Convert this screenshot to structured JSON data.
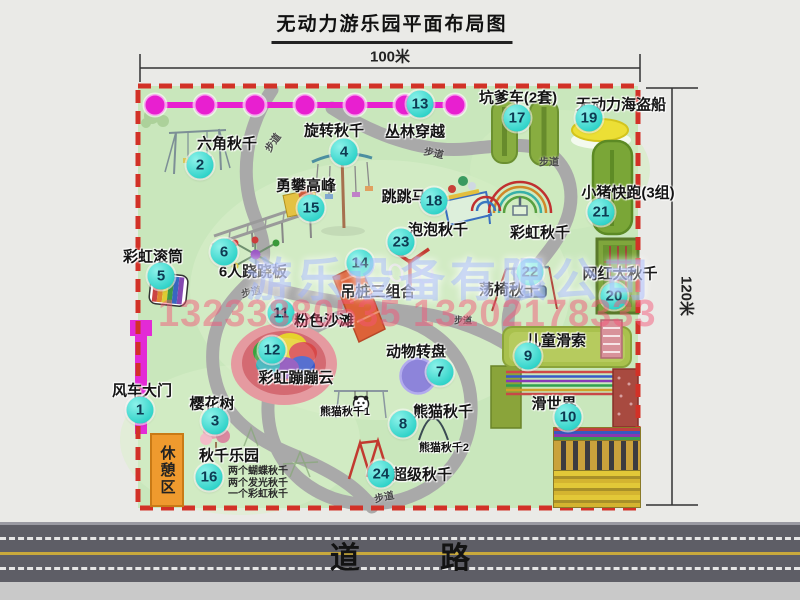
{
  "title": "无动力游乐园平面布局图",
  "dimensions": {
    "width": "100米",
    "height": "120米"
  },
  "road_label": "道 路",
  "rest_area_label": "休憩区",
  "path_label": "步道",
  "watermark": {
    "company": "游乐设备有限公司",
    "phone": "13233880535 13202178333"
  },
  "extra_labels": {
    "rainbow_swing": "彩虹秋千",
    "panda_swing_1": "熊猫秋千1",
    "panda_swing_2": "熊猫秋千2"
  },
  "swing_park_notes": [
    "两个蝴蝶秋千",
    "两个发光秋千",
    "一个彩虹秋千"
  ],
  "colors": {
    "badge_cyan": "#2ed2c8",
    "border_red": "#d23127",
    "jungle_magenta": "#e81fd0",
    "map_green": "#c9e7bc",
    "road_gray": "#5e5e66",
    "watermark_pink": "#f45478",
    "watermark_blue": "#96acff"
  },
  "items": [
    {
      "num": "1",
      "label": "风车大门"
    },
    {
      "num": "2",
      "label": "六角秋千"
    },
    {
      "num": "3",
      "label": "樱花树"
    },
    {
      "num": "4",
      "label": "旋转秋千"
    },
    {
      "num": "5",
      "label": "彩虹滚筒"
    },
    {
      "num": "6",
      "label": "6人跷跷板"
    },
    {
      "num": "7",
      "label": "动物转盘"
    },
    {
      "num": "8",
      "label": "熊猫秋千"
    },
    {
      "num": "9",
      "label": "儿童滑索"
    },
    {
      "num": "10",
      "label": "滑世界"
    },
    {
      "num": "11",
      "label": "粉色沙滩"
    },
    {
      "num": "12",
      "label": "彩虹蹦蹦云"
    },
    {
      "num": "13",
      "label": "丛林穿越"
    },
    {
      "num": "14",
      "label": "吊桩三组合"
    },
    {
      "num": "15",
      "label": "勇攀高峰"
    },
    {
      "num": "16",
      "label": "秋千乐园"
    },
    {
      "num": "17",
      "label": "坑爹车(2套)"
    },
    {
      "num": "18",
      "label": "跳跳马"
    },
    {
      "num": "19",
      "label": "无动力海盗船"
    },
    {
      "num": "20",
      "label": "网红大秋千"
    },
    {
      "num": "21",
      "label": "小猪快跑(3组)"
    },
    {
      "num": "22",
      "label": "荡椅秋千"
    },
    {
      "num": "23",
      "label": "泡泡秋千"
    },
    {
      "num": "24",
      "label": "超级秋千"
    }
  ]
}
